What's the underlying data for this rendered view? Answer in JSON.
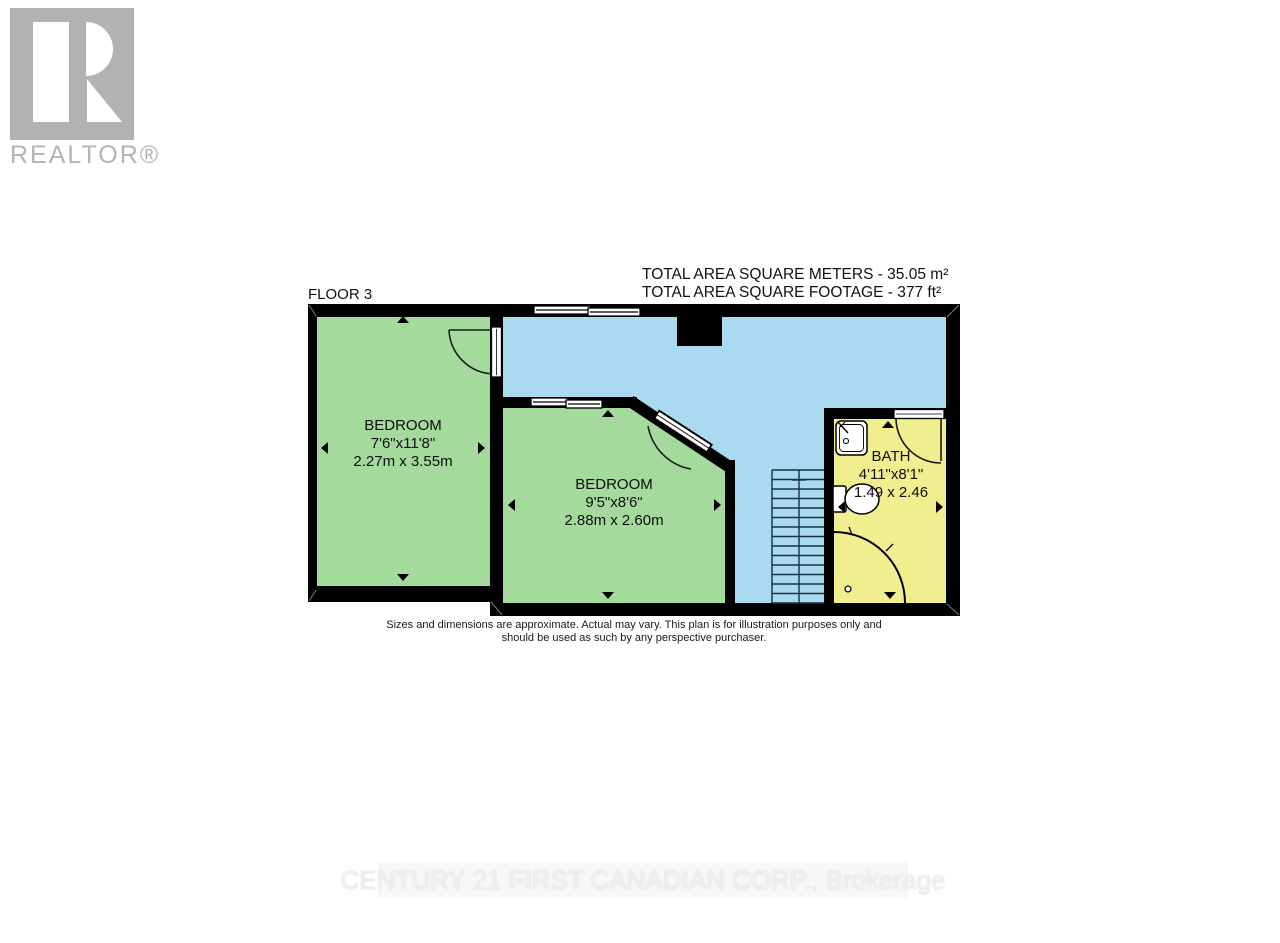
{
  "branding": {
    "realtor_logo_text": "REALTOR®",
    "realtor_logo_color": "#b2b2b2",
    "footer_watermark": "CENTURY 21 FIRST CANADIAN CORP., Brokerage"
  },
  "header": {
    "floor_label": "FLOOR 3",
    "total_area_metric": "TOTAL AREA SQUARE METERS - 35.05 m²",
    "total_area_imperial": "TOTAL AREA SQUARE FOOTAGE - 377 ft²"
  },
  "rooms": [
    {
      "id": "bedroom-1",
      "name": "BEDROOM",
      "dims_imperial": "7'6\"x11'8\"",
      "dims_metric": "2.27m x 3.55m",
      "fill": "#a4db9c"
    },
    {
      "id": "bedroom-2",
      "name": "BEDROOM",
      "dims_imperial": "9'5\"x8'6\"",
      "dims_metric": "2.88m x 2.60m",
      "fill": "#a4db9c"
    },
    {
      "id": "bath",
      "name": "BATH",
      "dims_imperial": "4'11\"x8'1\"",
      "dims_metric": "1.49 x 2.46",
      "fill": "#f0ee8e"
    }
  ],
  "plan": {
    "hallway_fill": "#a9daef",
    "wall_color": "#000000",
    "visible_features": [
      "windows",
      "doors",
      "stairs",
      "chimney-notch",
      "sink",
      "toilet",
      "shower",
      "dimension-arrows"
    ]
  },
  "disclaimer": {
    "line1": "Sizes and dimensions are approximate. Actual may vary. This plan is for illustration purposes only and",
    "line2": "should be used as such by any perspective purchaser."
  }
}
